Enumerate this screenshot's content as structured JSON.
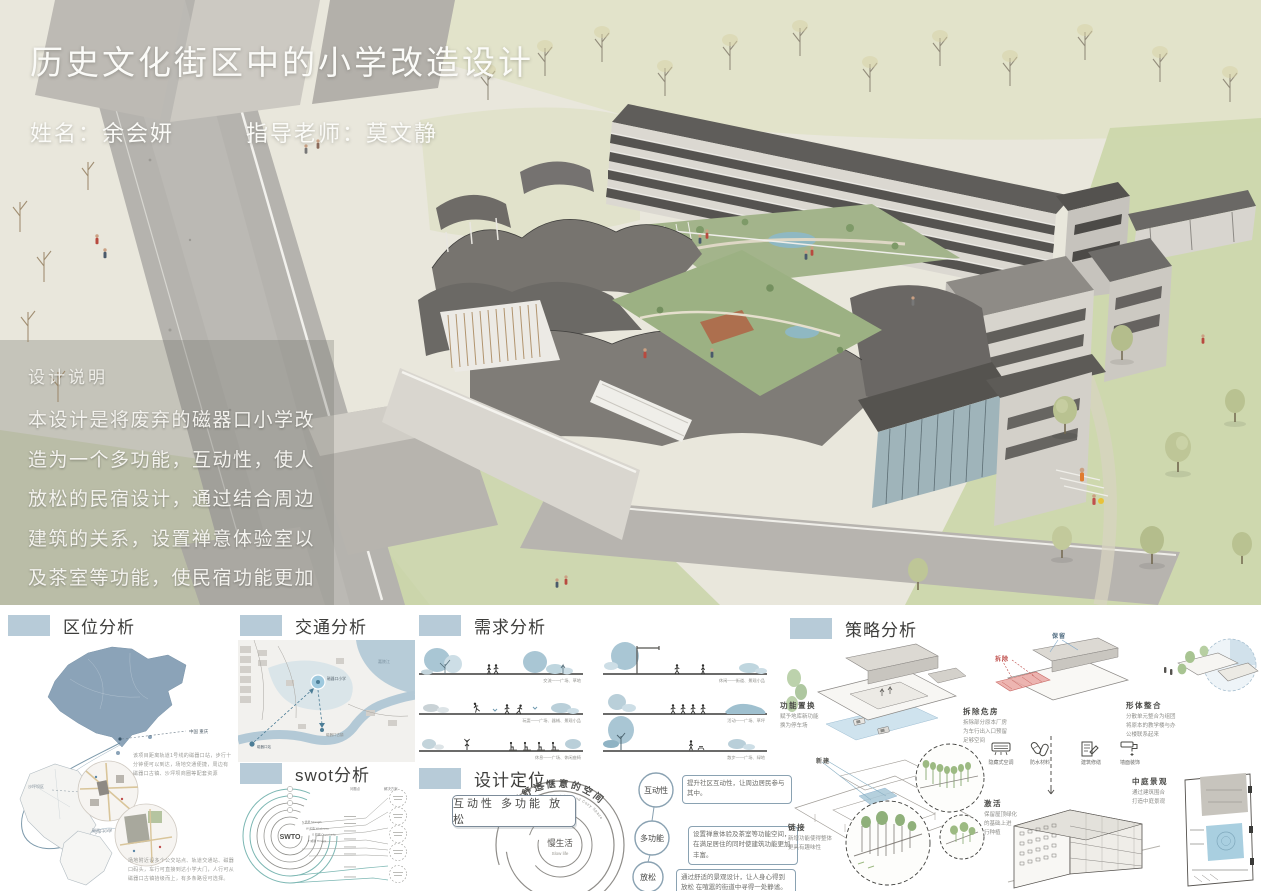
{
  "poster": {
    "title": "历史文化街区中的小学改造设计",
    "name_label": "姓名：余会妍",
    "advisor_label": "指导老师：莫文静"
  },
  "description": {
    "heading": "设计说明",
    "body": "本设计是将废弃的磁器口小学改造为一个多功能，互动性，使人放松的民宿设计，通过结合周边建筑的关系，设置禅意体验室以及茶室等功能，使民宿功能更加具有趣味性，在喧闹的旅游街区中，寻得一处静谧之所。"
  },
  "location": {
    "heading": "区位分析",
    "label_country": "中国 重庆",
    "label_district": "沙坪坝区",
    "label_site": "磁器口小学",
    "note_metro": "该项目距离轨道1号线的磁器口站，步行十分钟便可以到达，场地交通便捷，周边有磁器口古镇、沙坪坝商圈等配套资源",
    "note_site": "场地附近设多个公交站点、轨道交通站、磁器口码头，车行可直接到达小学大门，人行可从磁器口古镇拾级而上，有多条路径可选择。"
  },
  "traffic": {
    "heading": "交通分析",
    "label_river": "嘉陵江",
    "label_site": "磁器口小学",
    "label_station": "磁器口站",
    "label_town": "磁器口古镇"
  },
  "swot": {
    "heading": "swot分析",
    "center": "SWTO",
    "column_headers": [
      "问题点",
      "解决方案"
    ],
    "arc_labels": [
      "S 优势 Strength",
      "W 劣势 Weakness",
      "O 机遇 Opportunity",
      "T 威胁 Threats"
    ]
  },
  "needs": {
    "heading": "需求分析",
    "captions": [
      "交流——广场、草地",
      "玩耍——广场、器械、景观小品",
      "休息——广场、休闲座椅",
      "休闲——街道、景观小品",
      "活动——广场、草坪",
      "散步——广场、绿地"
    ]
  },
  "positioning": {
    "heading": "设计定位",
    "spiral_cn": "打造舒适惬意的空间",
    "spiral_en": "Creating a Comfortable and Cozy Space",
    "center_cn": "慢生活",
    "center_en": "Slow life",
    "keywords": "互动性 多功能 放松",
    "bullets": [
      {
        "label": "互动性",
        "text": "提升社区互动性，让周边居民参与其中。"
      },
      {
        "label": "多功能",
        "text": "设置禅意体验及茶室等功能空间，在满足居住的同时使建筑功能更加丰富。"
      },
      {
        "label": "放松",
        "text": "通过舒适的景观设计，让人身心得到放松 在喧嚣的街道中寻得一处静谧。"
      }
    ]
  },
  "strategy": {
    "heading": "策略分析",
    "steps": [
      {
        "title": "功能置换",
        "text": "赋予地库新功能\n换为停车场"
      },
      {
        "title": "拆除危房",
        "text": "拆除部分原本厂房\n为车行出入口预留\n足够空间"
      },
      {
        "title": "形体整合",
        "text": "分散单元整合为组团\n将原本的教学楼与办\n公楼联系起来"
      },
      {
        "title": "链接",
        "text": "新增功能使得整体\n更具有趣味性"
      },
      {
        "title": "激活",
        "text": "保留屋顶绿化\n的基础上进\n行种植"
      },
      {
        "title": "中庭景观",
        "text": "通过建筑围合\n打造中庭景观"
      }
    ],
    "tags": {
      "demolish": "拆除",
      "keep": "保留",
      "new": "新建"
    },
    "icons": [
      "隐藏式空调",
      "防水材料",
      "建筑修缮",
      "墙面装饰"
    ]
  }
}
